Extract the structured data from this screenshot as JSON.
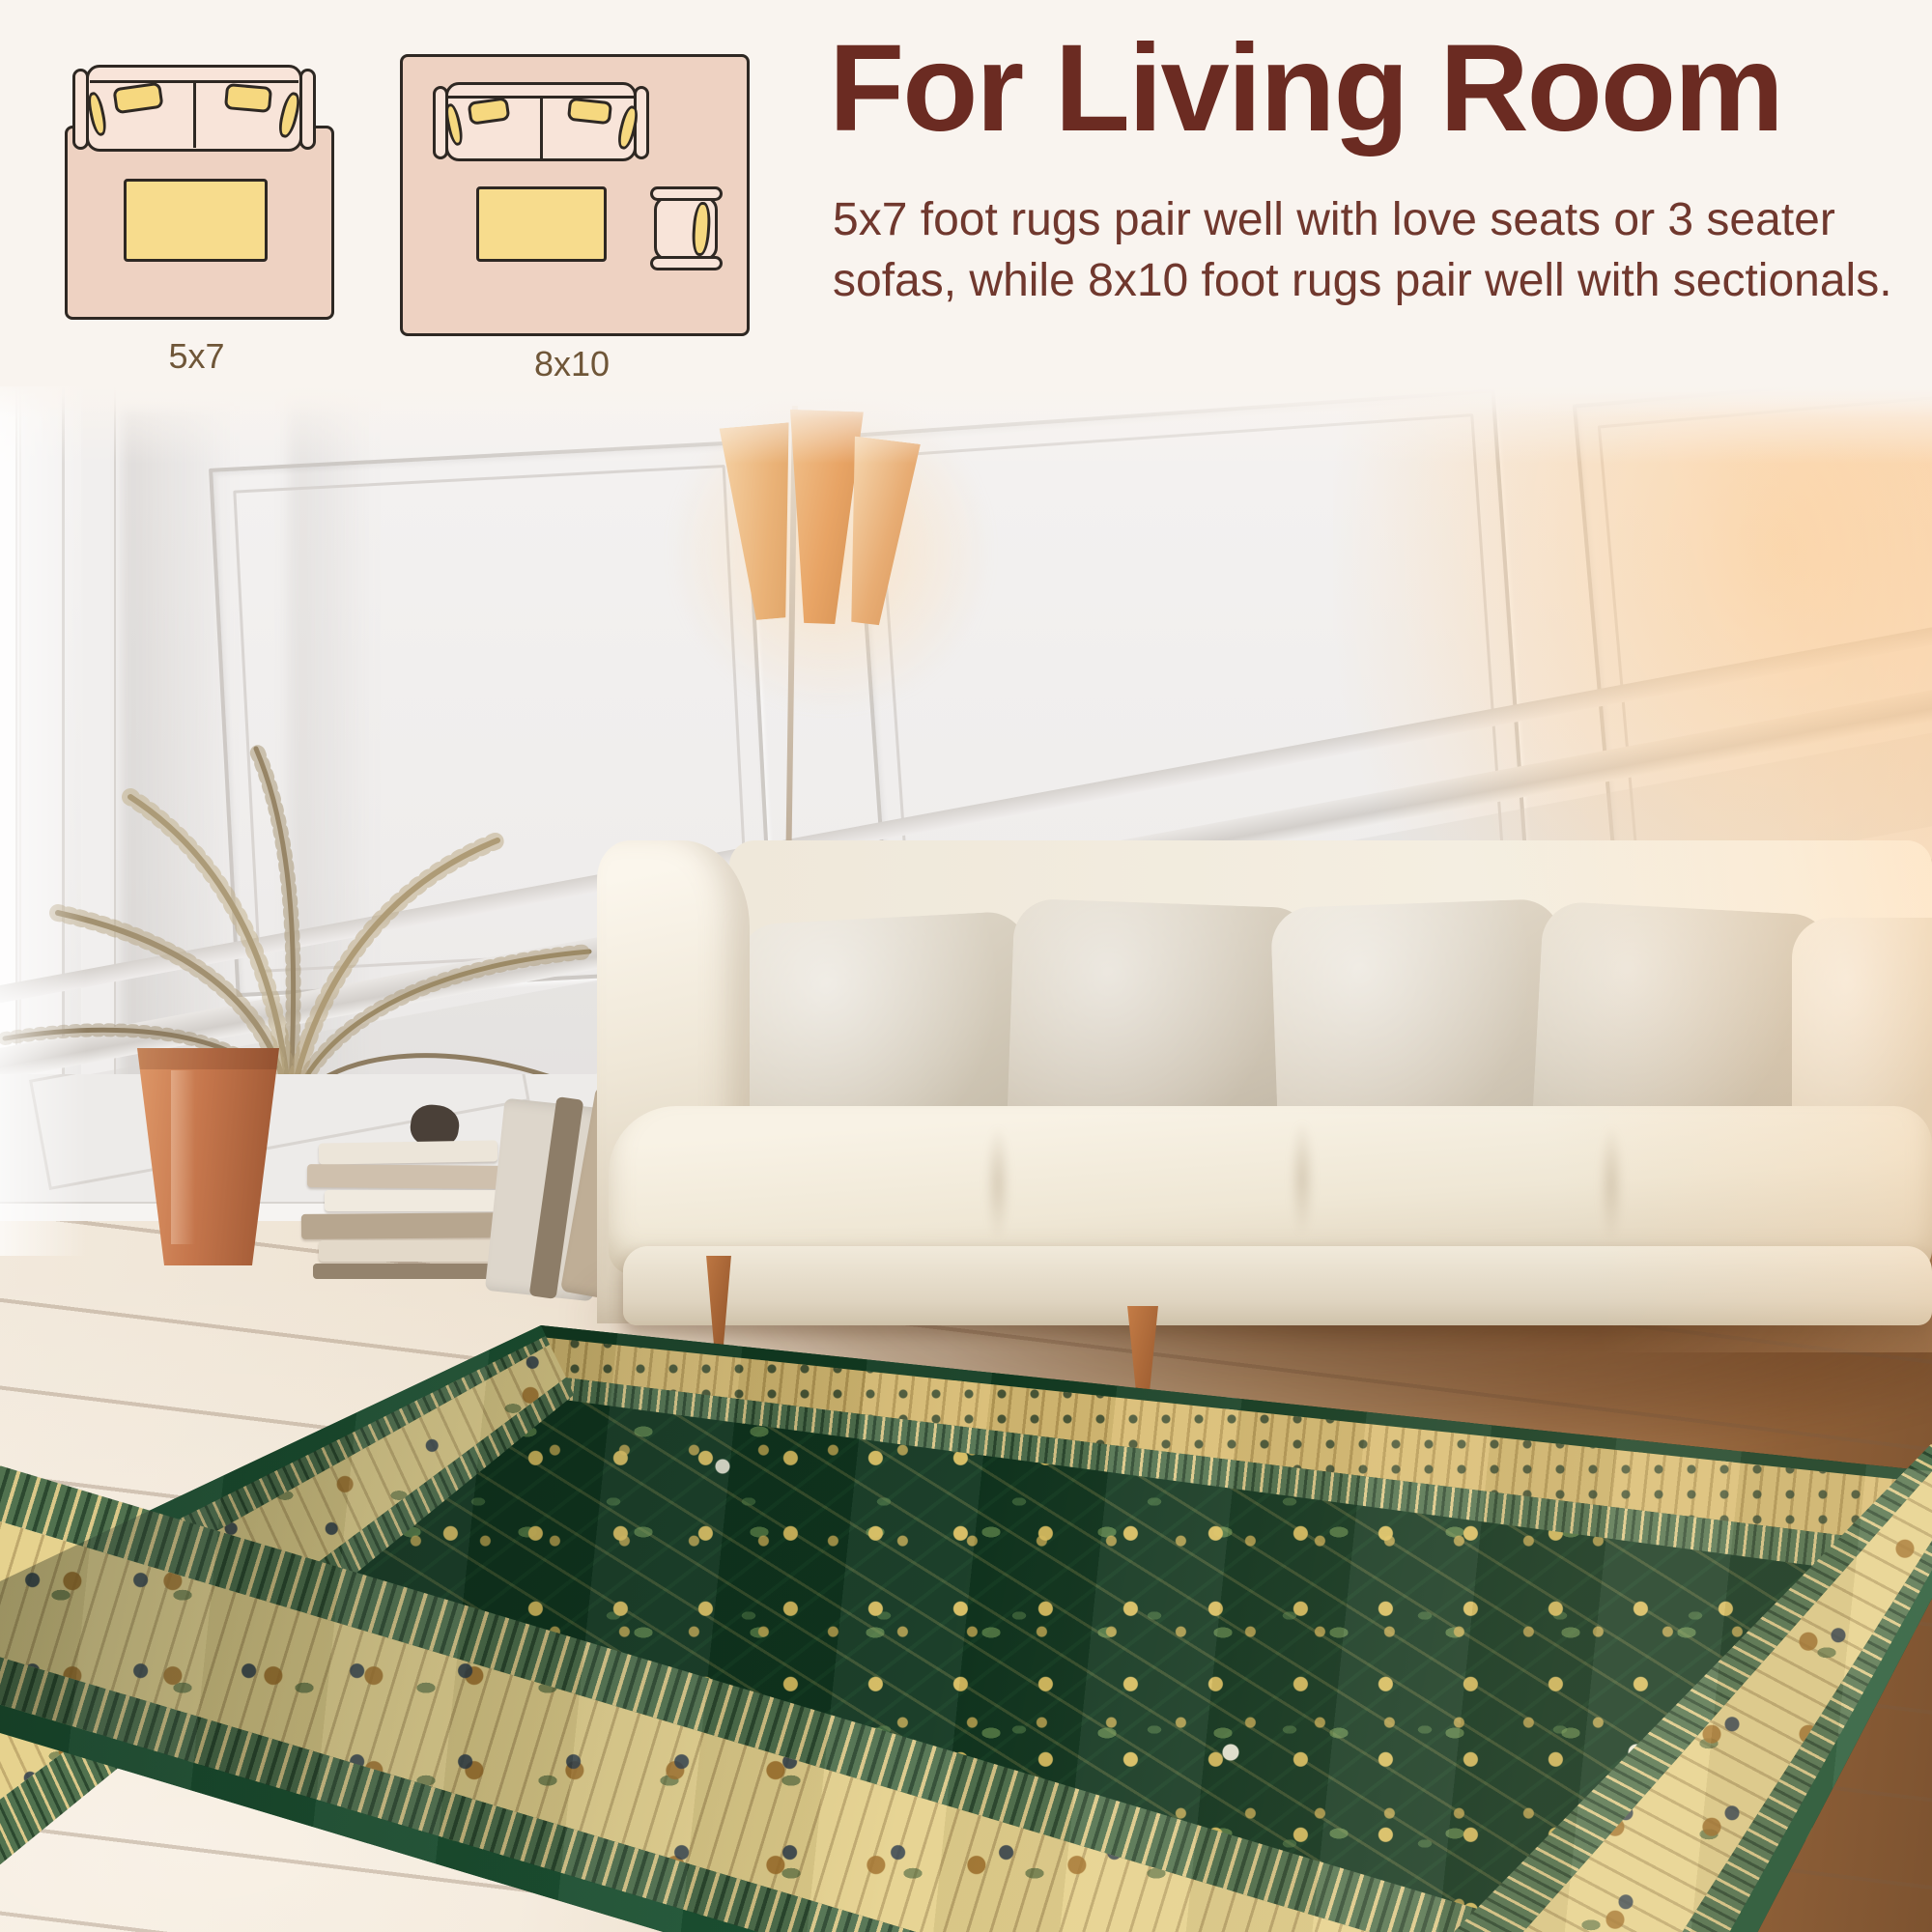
{
  "header": {
    "title": "For Living Room",
    "description": "5x7 foot rugs pair well with love seats or 3 seater sofas, while 8x10 foot rugs pair well with sectionals."
  },
  "size_diagrams": [
    {
      "label": "5x7"
    },
    {
      "label": "8x10"
    }
  ],
  "colors": {
    "heading_text": "#6b2b22",
    "body_text": "#70382e",
    "info_background": "#f9f4ef",
    "diagram_rug_pink": "#eed2c2",
    "diagram_cushion_yellow": "#f6d87f",
    "diagram_outline": "#2e2823",
    "rug_field_green": "#12391f",
    "rug_border_cream": "#e6d28e",
    "rug_motif_gold": "#d9b45a",
    "rug_edge_green": "#1d5434",
    "rug_flower_white": "#f6f2e4",
    "sofa_cream": "#f3ecdf",
    "pillow_gray_beige": "#d8d0c1",
    "pot_terracotta": "#c5764c",
    "lamp_shade_orange": "#e8ab72",
    "floor_wood_light": "#efe4d4",
    "floor_wood_warm": "#9a6a42",
    "wall_white": "#efedec"
  }
}
